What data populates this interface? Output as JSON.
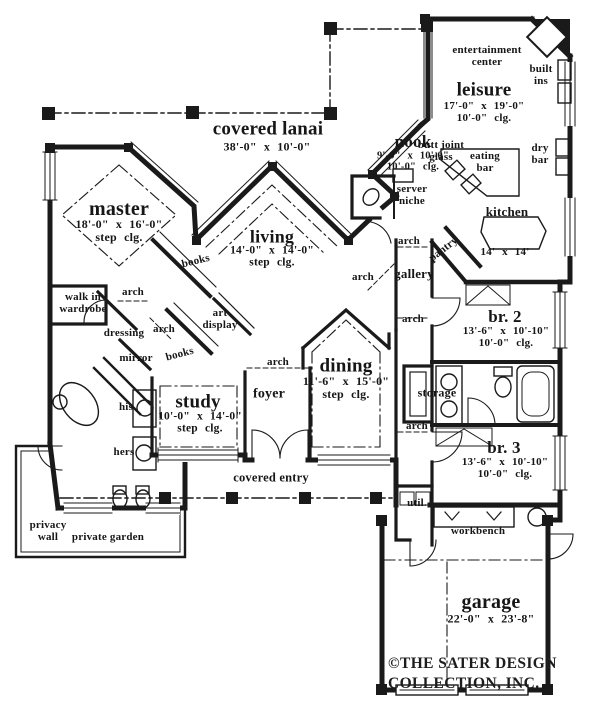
{
  "document": {
    "footer_line1": "©THE SATER DESIGN",
    "footer_line2": "COLLECTION, INC."
  },
  "colors": {
    "ink": "#1a1a1a",
    "paper": "#ffffff"
  },
  "labels": [
    {
      "id": "covered-lanai",
      "t": "covered lanai",
      "x": 268,
      "y": 130,
      "s": 19
    },
    {
      "id": "covered-lanai-dims",
      "t": "38'-0\" x 10'-0\"",
      "x": 267,
      "y": 147,
      "s": 12
    },
    {
      "id": "butt-joint-glass",
      "t": "butt joint\nglass",
      "x": 441,
      "y": 152,
      "s": 11
    },
    {
      "id": "nook",
      "t": "nook",
      "x": 413,
      "y": 142,
      "s": 17
    },
    {
      "id": "nook-dims",
      "t": "9'-0\" x 10'-0\"\n10'-0\" clg.",
      "x": 413,
      "y": 162,
      "s": 10.5
    },
    {
      "id": "entertainment-center",
      "t": "entertainment\ncenter",
      "x": 487,
      "y": 57,
      "s": 11
    },
    {
      "id": "built-ins",
      "t": "built\nins",
      "x": 541,
      "y": 76,
      "s": 11
    },
    {
      "id": "leisure",
      "t": "leisure",
      "x": 484,
      "y": 91,
      "s": 19
    },
    {
      "id": "leisure-dims",
      "t": "17'-0\" x 19'-0\"\n10'-0\" clg.",
      "x": 484,
      "y": 113,
      "s": 11
    },
    {
      "id": "eating-bar",
      "t": "eating\nbar",
      "x": 485,
      "y": 163,
      "s": 11
    },
    {
      "id": "dry-bar",
      "t": "dry\nbar",
      "x": 540,
      "y": 155,
      "s": 11
    },
    {
      "id": "server-niche",
      "t": "server\nniche",
      "x": 412,
      "y": 196,
      "s": 11
    },
    {
      "id": "kitchen",
      "t": "kitchen",
      "x": 507,
      "y": 212,
      "s": 13
    },
    {
      "id": "kitchen-dims",
      "t": "14' x 14'",
      "x": 505,
      "y": 253,
      "s": 11
    },
    {
      "id": "pantry",
      "t": "pantry",
      "x": 444,
      "y": 250,
      "s": 11,
      "r": -38
    },
    {
      "id": "master",
      "t": "master",
      "x": 119,
      "y": 210,
      "s": 20
    },
    {
      "id": "master-dims",
      "t": "18'-0\" x 16'-0\"\nstep clg.",
      "x": 119,
      "y": 231,
      "s": 12
    },
    {
      "id": "books-master",
      "t": "books",
      "x": 196,
      "y": 262,
      "s": 11,
      "r": -14
    },
    {
      "id": "arch-master",
      "t": "arch",
      "x": 133,
      "y": 293,
      "s": 11
    },
    {
      "id": "walk-in-wardrobe",
      "t": "walk in\nwardrobe",
      "x": 83,
      "y": 304,
      "s": 11
    },
    {
      "id": "dressing",
      "t": "dressing",
      "x": 124,
      "y": 334,
      "s": 11
    },
    {
      "id": "arch-dressing",
      "t": "arch",
      "x": 164,
      "y": 330,
      "s": 11
    },
    {
      "id": "art-display",
      "t": "art\ndisplay",
      "x": 220,
      "y": 320,
      "s": 11
    },
    {
      "id": "mirror",
      "t": "mirror",
      "x": 136,
      "y": 359,
      "s": 11
    },
    {
      "id": "books-study",
      "t": "books",
      "x": 180,
      "y": 355,
      "s": 11,
      "r": -15
    },
    {
      "id": "his",
      "t": "his",
      "x": 126,
      "y": 408,
      "s": 11
    },
    {
      "id": "hers",
      "t": "hers",
      "x": 124,
      "y": 453,
      "s": 11
    },
    {
      "id": "study",
      "t": "study",
      "x": 198,
      "y": 403,
      "s": 19
    },
    {
      "id": "study-dims",
      "t": "10'-0\" x 14'-0\"\nstep clg.",
      "x": 200,
      "y": 423,
      "s": 11.5
    },
    {
      "id": "living",
      "t": "living",
      "x": 272,
      "y": 237,
      "s": 18
    },
    {
      "id": "living-dims",
      "t": "14'-0\" x 14'-0\"\nstep clg.",
      "x": 272,
      "y": 257,
      "s": 11.5
    },
    {
      "id": "arch-foyer",
      "t": "arch",
      "x": 278,
      "y": 363,
      "s": 11
    },
    {
      "id": "foyer",
      "t": "foyer",
      "x": 269,
      "y": 394,
      "s": 14
    },
    {
      "id": "dining",
      "t": "dining",
      "x": 346,
      "y": 367,
      "s": 19
    },
    {
      "id": "dining-dims",
      "t": "11'-6\" x 15'-0\"\nstep clg.",
      "x": 346,
      "y": 388,
      "s": 12
    },
    {
      "id": "arch-gallery-left",
      "t": "arch",
      "x": 363,
      "y": 278,
      "s": 11
    },
    {
      "id": "gallery",
      "t": "gallery",
      "x": 414,
      "y": 274,
      "s": 13
    },
    {
      "id": "arch-gallery-top",
      "t": "arch",
      "x": 409,
      "y": 242,
      "s": 11
    },
    {
      "id": "arch-gallery-bottom",
      "t": "arch",
      "x": 413,
      "y": 320,
      "s": 11
    },
    {
      "id": "arch-hall",
      "t": "arch",
      "x": 417,
      "y": 427,
      "s": 11
    },
    {
      "id": "storage",
      "t": "storage",
      "x": 437,
      "y": 393,
      "s": 12
    },
    {
      "id": "br2",
      "t": "br. 2",
      "x": 505,
      "y": 317,
      "s": 17
    },
    {
      "id": "br2-dims",
      "t": "13'-6\" x 10'-10\"\n10'-0\" clg.",
      "x": 506,
      "y": 338,
      "s": 11
    },
    {
      "id": "br3",
      "t": "br. 3",
      "x": 504,
      "y": 448,
      "s": 17
    },
    {
      "id": "br3-dims",
      "t": "13'-6\" x 10'-10\"\n10'-0\" clg.",
      "x": 505,
      "y": 469,
      "s": 11
    },
    {
      "id": "util",
      "t": "util.",
      "x": 417,
      "y": 504,
      "s": 11
    },
    {
      "id": "covered-entry",
      "t": "covered entry",
      "x": 271,
      "y": 478,
      "s": 12.5
    },
    {
      "id": "workbench",
      "t": "workbench",
      "x": 478,
      "y": 532,
      "s": 11
    },
    {
      "id": "garage",
      "t": "garage",
      "x": 491,
      "y": 603,
      "s": 20
    },
    {
      "id": "garage-dims",
      "t": "22'-0\" x 23'-8\"",
      "x": 491,
      "y": 619,
      "s": 12
    },
    {
      "id": "privacy-wall",
      "t": "privacy\nwall",
      "x": 48,
      "y": 532,
      "s": 11
    },
    {
      "id": "private-garden",
      "t": "private garden",
      "x": 108,
      "y": 538,
      "s": 11
    }
  ]
}
